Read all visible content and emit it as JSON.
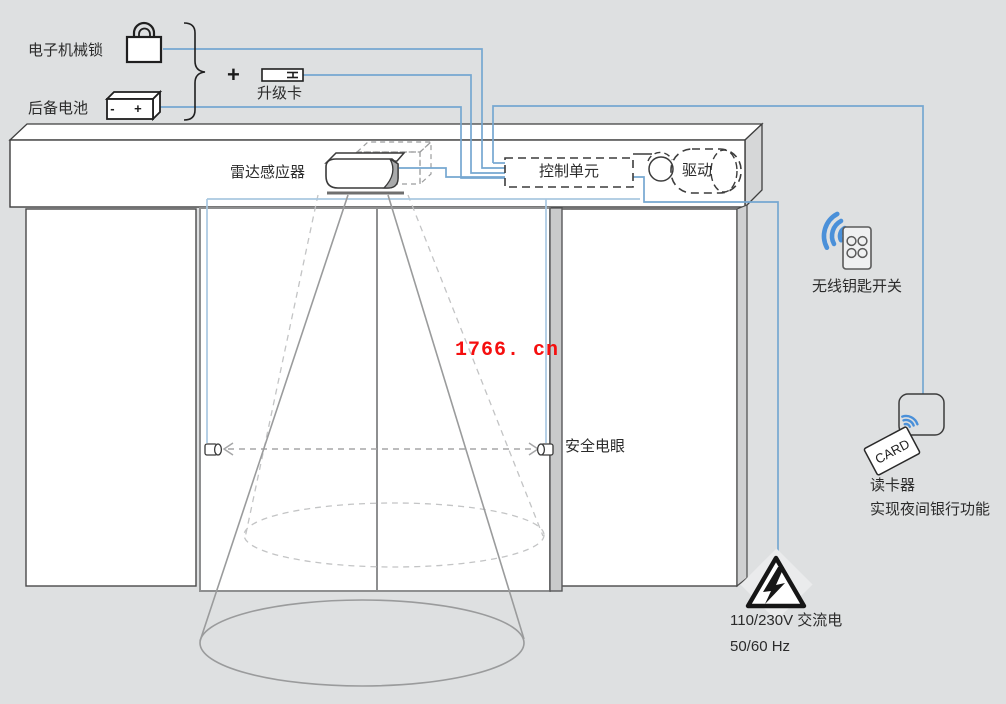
{
  "diagram_type": "automatic-sliding-door-system-schematic",
  "colors": {
    "background": "#dee0e1",
    "line_blue": "#76a7d1",
    "line_blue_light": "#a9c8e1",
    "wifi_blue": "#4a90d9",
    "watermark_red": "#f50f0f",
    "panel_white": "#ffffff",
    "cone_gray": "#9a9b9c"
  },
  "labels": {
    "electronic_lock": "电子机械锁",
    "backup_battery": "后备电池",
    "battery_terminals": "- +",
    "plus_sign": "+",
    "upgrade_card": "升级卡",
    "radar_sensor": "雷达感应器",
    "control_unit": "控制单元",
    "drive": "驱动",
    "wireless_key_switch": "无线钥匙开关",
    "safety_photocell": "安全电眼",
    "card_reader": "读卡器",
    "card_reader_function": "实现夜间银行功能",
    "card": "CARD",
    "power_voltage": "110/230V 交流电",
    "power_frequency": "50/60 Hz",
    "watermark": "1766. cn"
  },
  "icons": {
    "padlock-icon": "padlock shape",
    "battery-icon": "3d battery block with - + terminals",
    "upgrade-card-icon": "small card with contact stripes",
    "brace-icon": "right curly brace grouping lock and battery",
    "radar-sensor-icon": "rounded sensor box on door header",
    "drive-pulley-icon": "belt pulley circle",
    "drive-motor-icon": "dashed motor capsule",
    "wifi-waves-icon": "three blue radio arcs",
    "remote-control-icon": "handheld remote with 4 buttons",
    "photocell-icon": "small cylinder photo eye",
    "beam-arrow-icon": "dashed double arrow between photocells",
    "contactless-icon": "blue rfid arcs in rounded square",
    "card-icon": "tilted CARD badge",
    "power-warning-icon": "triangle with lightning bolt",
    "sensor-cone": "detection cone with floor ellipses"
  }
}
